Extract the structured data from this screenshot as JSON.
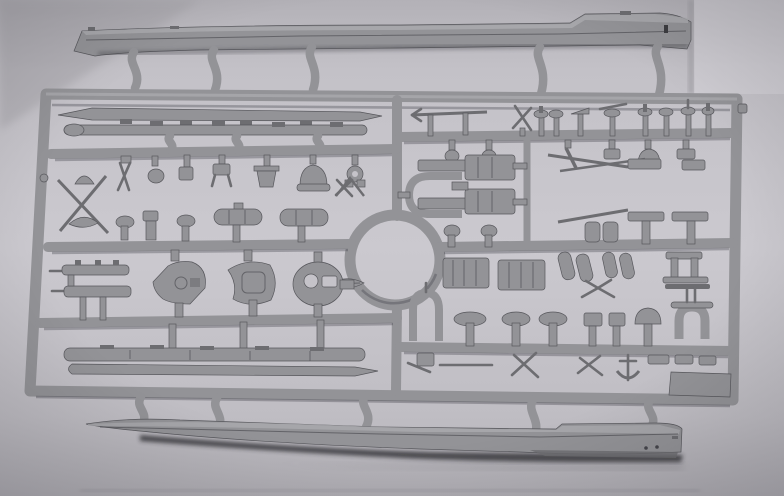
{
  "scene": {
    "description": "Photograph of a gray injection-molded polystyrene model kit sprue lying on a light gray surface: two long warship hull halves attached above and below a rectangular runner frame filled with small parts, with a circular runner ring at the center",
    "subject": "plastic model kit sprue",
    "orientation": "landscape"
  },
  "colors": {
    "background": "#c5c3c9",
    "background_light": "#d7d5db",
    "background_shade": "#a7a5ab",
    "plastic": "#939397",
    "plastic_light": "#acacb0",
    "plastic_dark": "#6d6d71",
    "plastic_edge": "#57575c",
    "shadow": "#26262a"
  },
  "objects": {
    "top_part": "upper ship hull half",
    "bottom_part": "lower ship hull half",
    "frame": "rectangular sprue runner frame",
    "center_part": "circular runner ring",
    "left_parts": "deck strips, tripod mast spars, small fittings, funnel cylinders, three gun turrets, twin gun mounts, lower deck strips",
    "right_parts": "yardarms, capped posts, superstructure decks with U-shaped davit, deckhouse blocks, slanted cylinder pairs, platform tables, U-fairlead, anchor, corner plate"
  }
}
